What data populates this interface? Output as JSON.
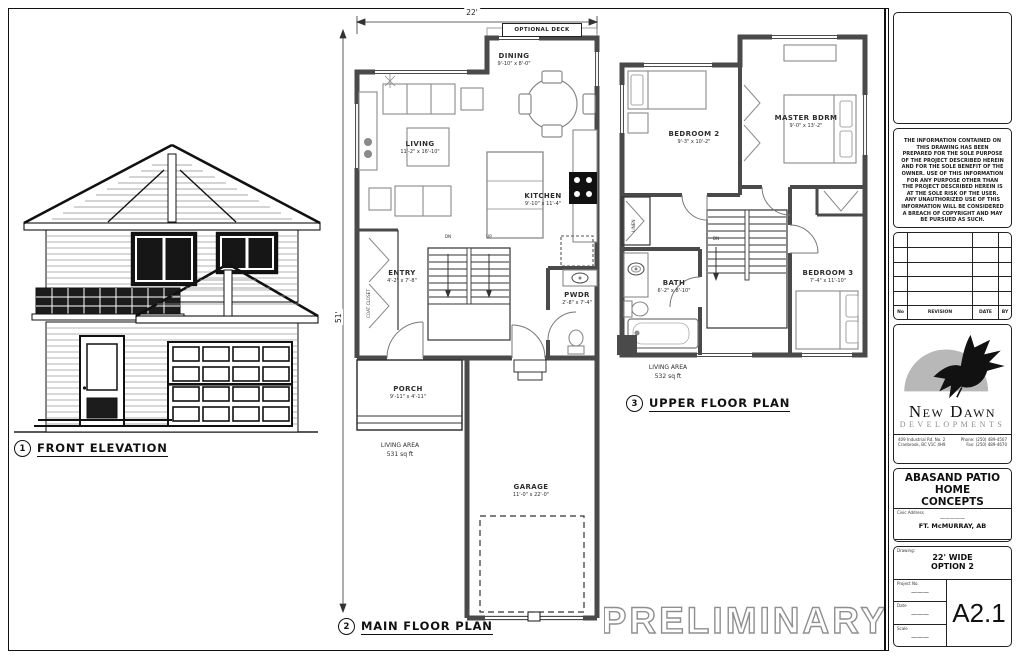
{
  "views": {
    "elevation": {
      "number": "1",
      "title": "FRONT ELEVATION"
    },
    "main_floor": {
      "number": "2",
      "title": "MAIN FLOOR PLAN"
    },
    "upper_floor": {
      "number": "3",
      "title": "UPPER FLOOR PLAN"
    }
  },
  "main_floor": {
    "width_dim": "22'",
    "depth_dim": "51'",
    "optional_deck": "OPTIONAL DECK",
    "living": {
      "name": "LIVING",
      "size": "11'-2\" x 16'-10\""
    },
    "dining": {
      "name": "DINING",
      "size": "9'-10\" x 8'-0\""
    },
    "kitchen": {
      "name": "KITCHEN",
      "size": "9'-10\" x 11'-4\""
    },
    "entry": {
      "name": "ENTRY",
      "size": "4'-2\" x 7'-8\""
    },
    "pwdr": {
      "name": "PWDR",
      "size": "2'-8\" x 7'-4\""
    },
    "porch": {
      "name": "PORCH",
      "size": "9'-11\" x 4'-11\""
    },
    "garage": {
      "name": "GARAGE",
      "size": "11'-0\" x 22'-0\""
    },
    "coat_closet": "COAT CLOSET",
    "stair_down": "DN",
    "stair_up": "UP",
    "living_area_label": "LIVING AREA",
    "living_area_value": "531 sq ft"
  },
  "upper_floor": {
    "bedroom2": {
      "name": "BEDROOM 2",
      "size": "9'-3\" x 10'-2\""
    },
    "master": {
      "name": "MASTER BDRM",
      "size": "9'-0\" x 13'-2\""
    },
    "bath": {
      "name": "BATH",
      "size": "6'-2\" x 8'-10\""
    },
    "bedroom3": {
      "name": "BEDROOM 3",
      "size": "7'-4\" x 11'-10\""
    },
    "linen": "LINEN",
    "stair_down": "DN",
    "living_area_label": "LIVING AREA",
    "living_area_value": "532 sq ft"
  },
  "watermark": "PRELIMINARY",
  "title_block": {
    "copyright": "THE INFORMATION CONTAINED ON THIS DRAWING HAS BEEN PREPARED FOR THE SOLE PURPOSE OF THE PROJECT DESCRIBED HEREIN AND FOR THE SOLE BENEFIT OF THE OWNER. USE OF THIS INFORMATION FOR ANY PURPOSE OTHER THAN THE PROJECT DESCRIBED HEREIN IS AT THE SOLE RISK OF THE USER. ANY UNAUTHORIZED USE OF THIS INFORMATION WILL BE CONSIDERED A BREACH OF COPYRIGHT AND MAY BE PURSUED AS SUCH.",
    "revision": {
      "headers": [
        "No",
        "REVISION",
        "DATE",
        "BY"
      ]
    },
    "logo": {
      "company_line1": "New Dawn",
      "company_line2": "DEVELOPMENTS",
      "address_line1": "409 Industrial Rd. No. 2",
      "address_line2": "Cranbrook, BC  V1C 4H9",
      "phone": "Phone: (250) 489-4507",
      "fax": "Fax: (250) 489-4670"
    },
    "project": {
      "title_line1": "ABASAND PATIO HOME",
      "title_line2": "CONCEPTS",
      "civic_label": "Civic Address",
      "civic_dash": "—————",
      "civic_value": "FT. McMURRAY, AB",
      "legal_label": "Legal Address"
    },
    "drawing": {
      "label": "Drawing:",
      "line1": "22' WIDE",
      "line2": "OPTION 2",
      "project_no_label": "Project No.",
      "date_label": "Date",
      "scale_label": "Scale",
      "blank": "———",
      "sheet": "A2.1"
    }
  },
  "colors": {
    "wall": "#4a4a4a",
    "line": "#333333",
    "furniture": "#8a8a8a",
    "logo_gray": "#b8b8b8"
  }
}
